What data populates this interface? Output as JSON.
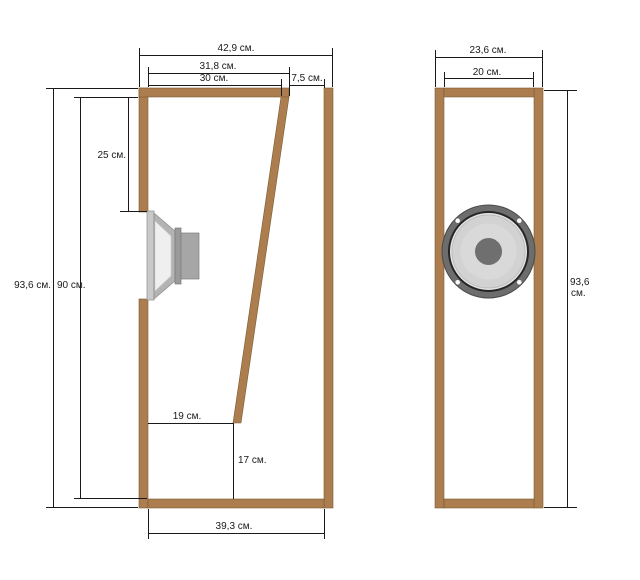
{
  "colors": {
    "wood": "#ab7d4f",
    "dim_line": "#1a1a1a",
    "driver_frame": "#6d6d6d",
    "driver_gasket": "#e3e3e3",
    "driver_cone": "#d2d2d2",
    "driver_cone_inner": "#d9d9d9",
    "driver_dustcap": "#6f6f6f",
    "driver_basket": "#b3b3b3",
    "driver_flange": "#c9c9c9",
    "driver_magnet": "#a6a6a6",
    "driver_plate": "#9a9a9a",
    "cone_cavity": "#efefef",
    "screw": "#fafafa"
  },
  "side_view": {
    "dim_overall_width": "42,9 см.",
    "dim_baffle_outer_width": "31,8 см.",
    "dim_top_inner_width": "30 см.",
    "dim_top_port_width": "7,5 см.",
    "dim_overall_height": "93,6 см.",
    "dim_inner_height": "90 см.",
    "dim_driver_top_offset": "25 см.",
    "dim_bottom_width_to_divider": "19 см.",
    "dim_bottom_gap_height": "17 см.",
    "dim_bottom_inner_width": "39,3 см."
  },
  "front_view": {
    "dim_overall_width": "23,6 см.",
    "dim_inner_width": "20 см.",
    "dim_overall_height_value": "93,6",
    "dim_overall_height_unit": "см."
  }
}
